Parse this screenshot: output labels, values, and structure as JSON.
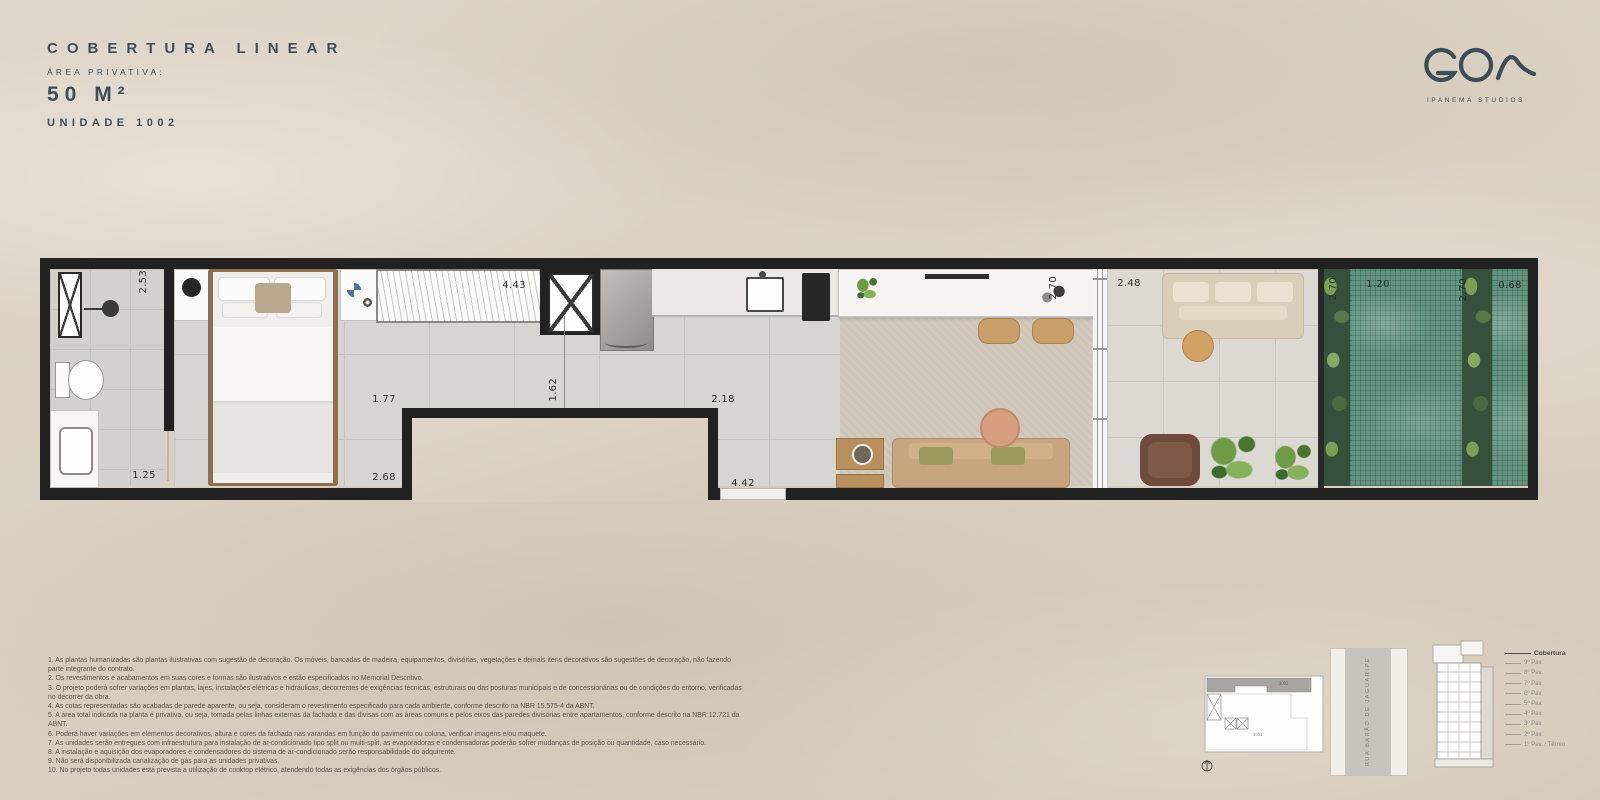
{
  "header": {
    "title": "COBERTURA LINEAR",
    "area_label": "ÁREA PRIVATIVA:",
    "area_value": "50 M²",
    "unit_label": "UNIDADE 1002"
  },
  "brand": {
    "logo_text": "GOA",
    "logo_subtitle": "IPANEMA STUDIOS"
  },
  "floorplan": {
    "dims": {
      "bathroom_depth": "2.53",
      "bathroom_width": "1.25",
      "wardrobe_width": "4.43",
      "bedroom_dim": "1.77",
      "bedroom_width": "2.68",
      "hall_width": "1.62",
      "kitchen_width": "2.18",
      "living_width": "4.42",
      "island_length": "2.70",
      "terrace_width": "2.48",
      "terrace_depth": "2.70",
      "pool_width": "1.20",
      "pool_depth": "2.70",
      "pool2_width": "0.68"
    }
  },
  "keyplan": {
    "unit_highlight": "1002",
    "unit_below": "1001",
    "street_name": "RUA BARÃO DE JAGUARIPE"
  },
  "building": {
    "floors": [
      "Cobertura",
      "9º Pav.",
      "8º Pav.",
      "7º Pav.",
      "6º Pav.",
      "5º Pav.",
      "4º Pav.",
      "3º Pav.",
      "2º Pav.",
      "1º Pav. / Térreo"
    ],
    "highlighted_floor": "Cobertura"
  },
  "disclaimer": {
    "lines": [
      "1. As plantas humanizadas são plantas ilustrativas com sugestão de decoração. Os móveis, bancadas de madeira, equipamentos, divisórias, vegetações e demais itens decorativos são sugestões de decoração, não fazendo parte integrante do contrato.",
      "2. Os revestimentos e acabamentos em suas cores e formas são ilustrativos e estão especificados no Memorial Descritivo.",
      "3. O projeto poderá sofrer variações em plantas, lajes, instalações elétricas e hidráulicas, decorrentes de exigências técnicas, estruturais ou das posturas municipais e de concessionárias ou de condições do entorno, verificadas no decorrer da obra.",
      "4. As cotas representadas são acabadas de parede aparente, ou seja, consideram o revestimento especificado para cada ambiente, conforme descrito na NBR 15.575-4 da ABNT.",
      "5. A área total indicada na planta é privativa, ou seja, tomada pelas linhas externas da fachada e das divisas com as áreas comuns e pelos eixos das paredes divisórias entre apartamentos, conforme descrito na NBR 12.721 da ABNT.",
      "6. Poderá haver variações em elementos decorativos, altura e cores da fachada nas varandas em função do pavimento ou coluna, verificar imagens e/ou maquete.",
      "7. As unidades serão entregues com infraestrutura para instalação de ar-condicionado tipo split ou multi-split, as evaporadoras e condensadoras poderão sofrer mudanças de posição ou quantidade, caso necessário.",
      "8. A instalação e aquisição dos evaporadores e condensadores do sistema de ar-condicionado serão responsabilidade do adquirente.",
      "9. Não será disponibilizada canalização de gás para as unidades privativas.",
      "10. No projeto todas unidades está prevista a utilização de cooktop elétrico, atendendo todas as exigências dos órgãos públicos."
    ]
  },
  "colors": {
    "accent": "#3d4e59",
    "wall": "#212121",
    "pool": "#639580",
    "background": "#d8cfc1"
  }
}
